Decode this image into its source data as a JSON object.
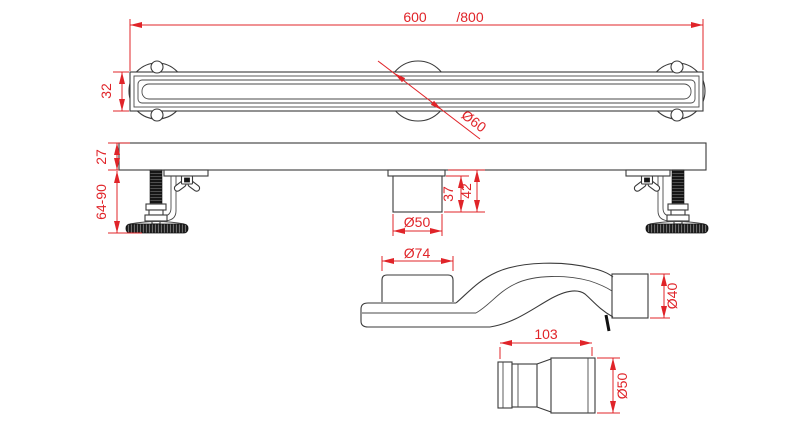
{
  "drawing": {
    "type": "technical-dimension-drawing",
    "subject": "linear shower drain channel with siphon trap and reducer fitting",
    "background_color": "#ffffff",
    "line_color": "#3a3a3a",
    "dimension_color": "#e02429"
  },
  "labels": {
    "length_primary": "600",
    "length_alt": "/800",
    "channel_width": "32",
    "flange_dia": "Ø60",
    "body_height": "27",
    "leg_range": "64-90",
    "spigot_proj": "37",
    "spigot_total": "42",
    "spigot_dia": "Ø50",
    "trap_inlet_dia": "Ø74",
    "trap_outlet_dia": "Ø40",
    "fitting_len": "103",
    "fitting_dia": "Ø50"
  }
}
